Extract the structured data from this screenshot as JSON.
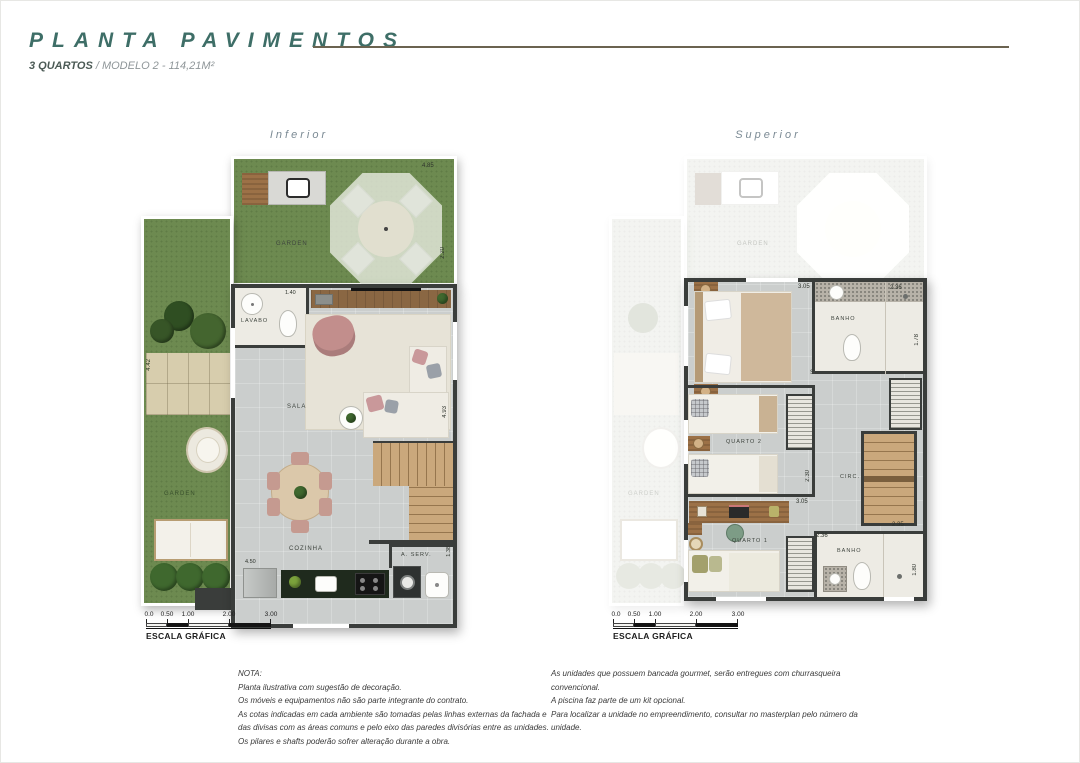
{
  "header": {
    "title": "PLANTA PAVIMENTOS",
    "subtitle_bold": "3 QUARTOS",
    "subtitle_rest": " / MODELO 2 - 114,21M²"
  },
  "plans": {
    "inferior": {
      "label": "Inferior",
      "rooms": {
        "garden_top": "GARDEN",
        "garden_left": "GARDEN",
        "lavabo": "LAVABO",
        "sala": "SALA",
        "cozinha": "COZINHA",
        "aserv": "A. SERV."
      },
      "dims": {
        "top": "4.85",
        "right": "2.20",
        "lavabo": "1.40",
        "kitchen_left": "4.50",
        "aserv_right": "1.38",
        "sala_right": "4.93",
        "garden_left": "4.42"
      }
    },
    "superior": {
      "label": "Superior",
      "rooms": {
        "garden_ghost_top": "GARDEN",
        "garden_ghost_left": "GARDEN",
        "suite": "SUÍTE",
        "banho_top": "BANHO",
        "quarto2": "QUARTO 2",
        "circ": "CIRC.",
        "quarto1": "QUARTO 1",
        "banho_bottom": "BANHO"
      },
      "dims": {
        "suite_top": "3.05",
        "banho_top": "2.36",
        "banho_right": "1.78",
        "quarto2_right": "2.30",
        "quarto1_top": "3.05",
        "stair_bottom": "2.35",
        "banho2_left": "2.36",
        "banho2_right": "1.80"
      }
    }
  },
  "scale": {
    "ticks": [
      "0.0",
      "0.50",
      "1.00",
      "2.00",
      "3.00"
    ],
    "label": "ESCALA GRÁFICA"
  },
  "notes_left": {
    "heading": "NOTA:",
    "lines": [
      "Planta ilustrativa com sugestão de decoração.",
      "Os móveis e equipamentos não são parte integrante do contrato.",
      "As cotas indicadas em cada ambiente são tomadas pelas linhas externas da fachada e",
      "das divisas com as áreas comuns e pelo eixo das paredes divisórias entre as unidades.",
      "Os pilares e shafts poderão sofrer alteração durante a obra."
    ]
  },
  "notes_right": {
    "lines": [
      "As unidades que possuem bancada gourmet, serão entregues com churrasqueira",
      "convencional.",
      "A piscina faz parte de um kit opcional.",
      "Para localizar a unidade no empreendimento, consultar no masterplan pelo número da",
      "unidade."
    ]
  },
  "colors": {
    "title": "#3e6e67",
    "rule": "#6b6350",
    "grass": "#6d8a50",
    "ghost_grass": "#dbe0cf",
    "wall": "#3a3d3b",
    "floor": "#cbcecd",
    "wood": "#9c7147"
  }
}
